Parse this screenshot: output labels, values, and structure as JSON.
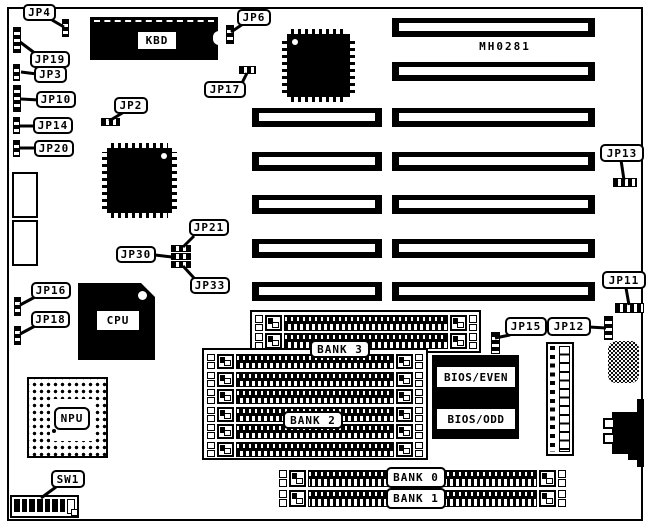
{
  "figure": {
    "part_number": "MH0281"
  },
  "chips": {
    "kbd": "KBD",
    "cpu": "CPU",
    "npu": "NPU",
    "bios_even": "BIOS/EVEN",
    "bios_odd": "BIOS/ODD"
  },
  "banks": {
    "bank0": "BANK 0",
    "bank1": "BANK 1",
    "bank2": "BANK 2",
    "bank3": "BANK 3"
  },
  "jumpers": {
    "jp2": "JP2",
    "jp3": "JP3",
    "jp4": "JP4",
    "jp6": "JP6",
    "jp10": "JP10",
    "jp11": "JP11",
    "jp12": "JP12",
    "jp13": "JP13",
    "jp14": "JP14",
    "jp15": "JP15",
    "jp16": "JP16",
    "jp17": "JP17",
    "jp18": "JP18",
    "jp19": "JP19",
    "jp20": "JP20",
    "jp21": "JP21",
    "jp30": "JP30",
    "jp33": "JP33"
  },
  "switches": {
    "sw1": "SW1"
  },
  "colors": {
    "silkscreen": "#000000",
    "board": "#ffffff"
  }
}
